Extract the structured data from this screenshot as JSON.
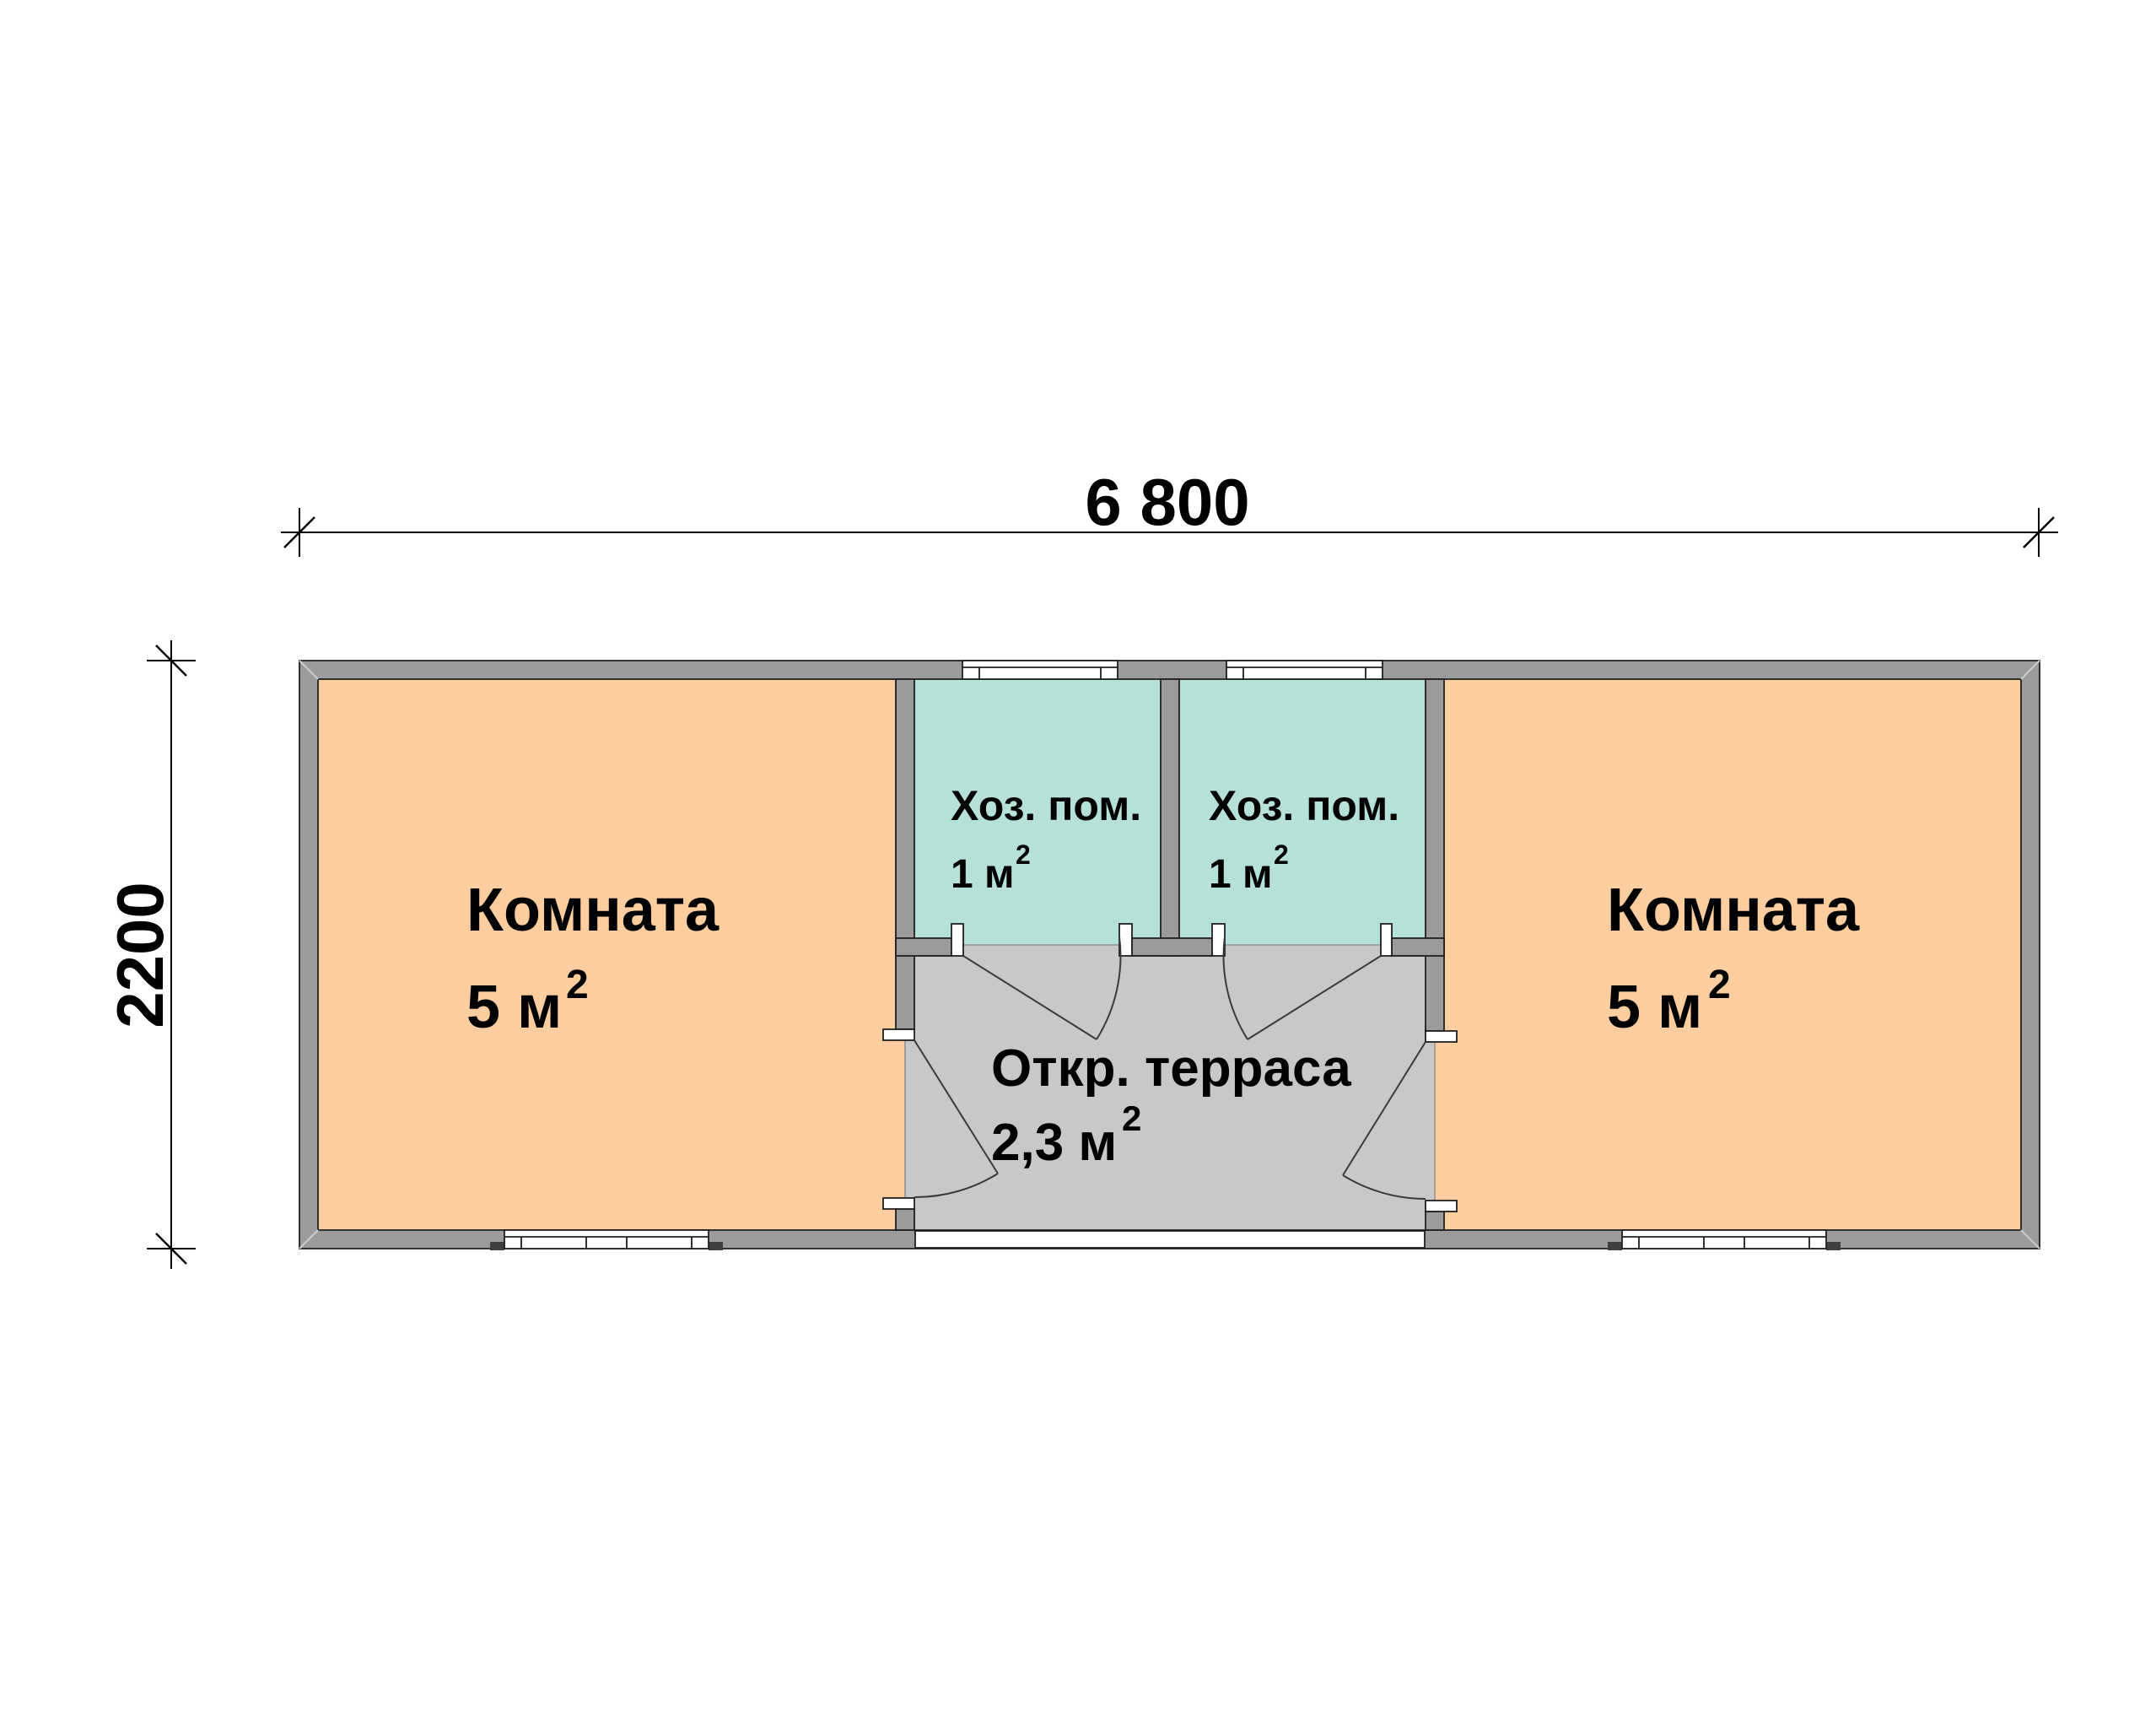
{
  "plan": {
    "title": "floor-plan",
    "dimensions": {
      "width_label": "6 800",
      "height_label": "2200"
    },
    "rooms": {
      "room_left": {
        "name": "Комната",
        "area": "5 м",
        "area_sup": "2"
      },
      "room_right": {
        "name": "Комната",
        "area": "5 м",
        "area_sup": "2"
      },
      "utility_left": {
        "name": "Хоз. пом.",
        "area": "1 м",
        "area_sup": "2"
      },
      "utility_right": {
        "name": "Хоз. пом.",
        "area": "1 м",
        "area_sup": "2"
      },
      "terrace": {
        "name": "Откр. терраса",
        "area": "2,3 м",
        "area_sup": "2"
      }
    },
    "colors": {
      "room_fill": "#FCCD9E",
      "utility_fill": "#B5E1D8",
      "terrace_fill": "#C8C8C8",
      "wall_fill": "#9B9B9B",
      "floor_base": "#FFFFFF"
    }
  }
}
